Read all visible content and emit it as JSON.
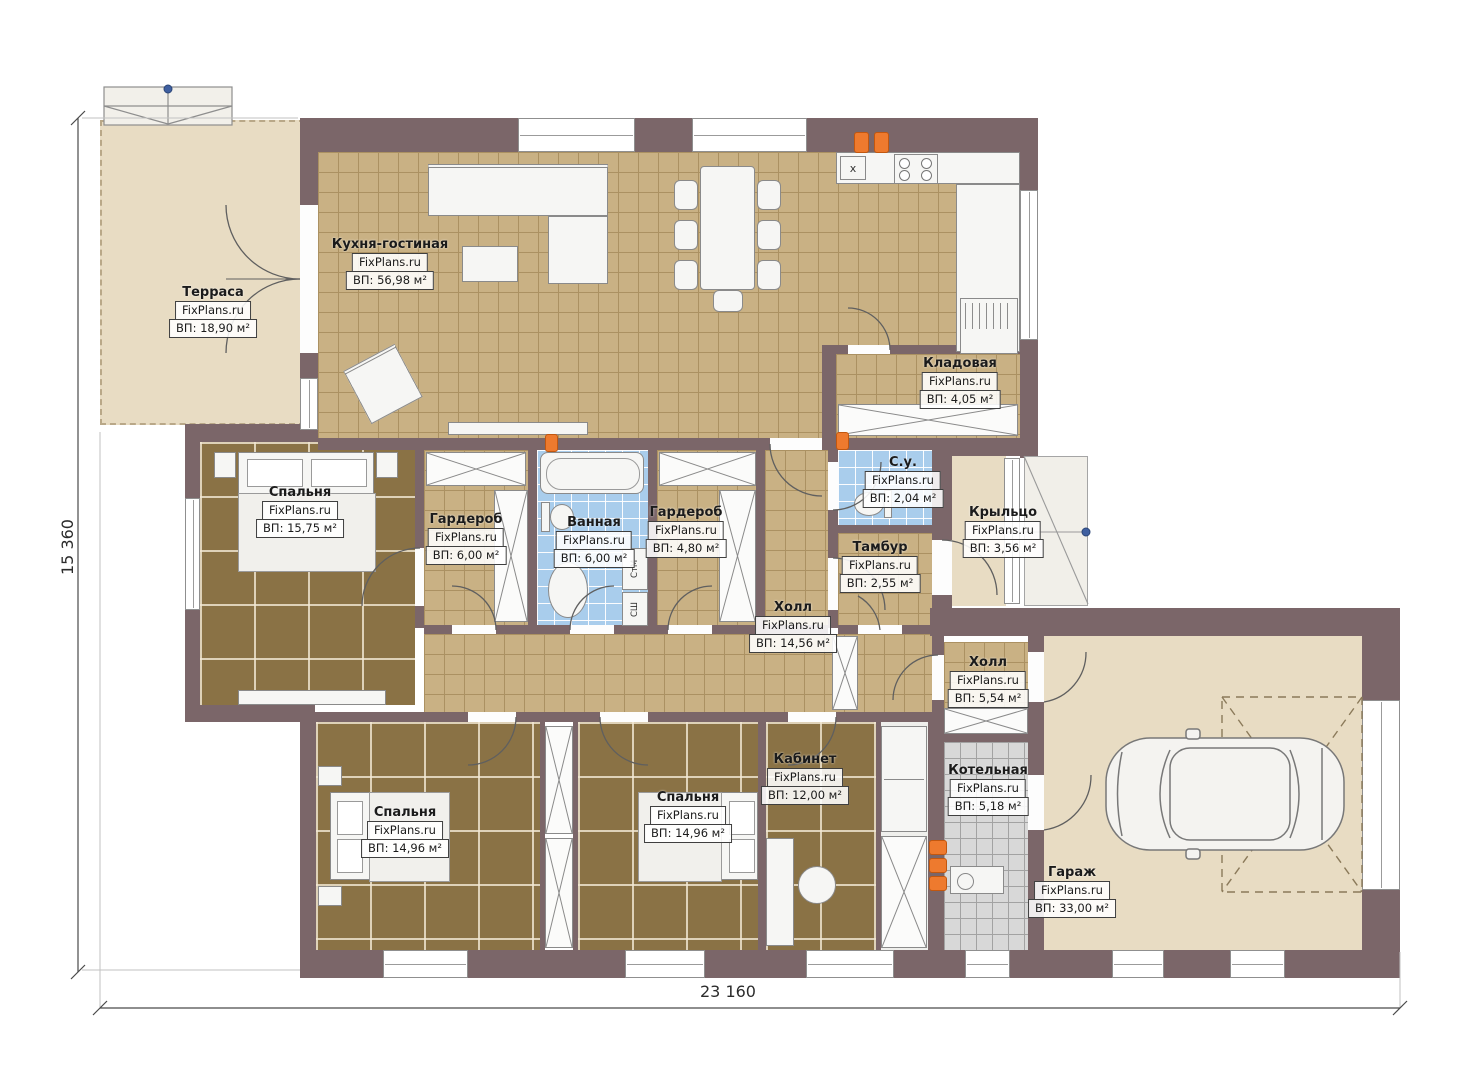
{
  "plan": {
    "dimension_bottom": "23 160",
    "dimension_left": "15 360"
  },
  "rooms": [
    {
      "name": "Терраса",
      "brand": "FixPlans.ru",
      "area": "ВП: 18,90 м²"
    },
    {
      "name": "Кухня-гостиная",
      "brand": "FixPlans.ru",
      "area": "ВП: 56,98 м²"
    },
    {
      "name": "Кладовая",
      "brand": "FixPlans.ru",
      "area": "ВП: 4,05 м²"
    },
    {
      "name": "Спальня",
      "brand": "FixPlans.ru",
      "area": "ВП: 15,75 м²"
    },
    {
      "name": "Гардероб",
      "brand": "FixPlans.ru",
      "area": "ВП: 6,00 м²"
    },
    {
      "name": "Ванная",
      "brand": "FixPlans.ru",
      "area": "ВП: 6,00 м²"
    },
    {
      "name": "Гардероб",
      "brand": "FixPlans.ru",
      "area": "ВП: 4,80 м²"
    },
    {
      "name": "С.у.",
      "brand": "FixPlans.ru",
      "area": "ВП: 2,04 м²"
    },
    {
      "name": "Тамбур",
      "brand": "FixPlans.ru",
      "area": "ВП: 2,55 м²"
    },
    {
      "name": "Крыльцо",
      "brand": "FixPlans.ru",
      "area": "ВП: 3,56 м²"
    },
    {
      "name": "Холл",
      "brand": "FixPlans.ru",
      "area": "ВП: 14,56 м²"
    },
    {
      "name": "Холл",
      "brand": "FixPlans.ru",
      "area": "ВП: 5,54 м²"
    },
    {
      "name": "Спальня",
      "brand": "FixPlans.ru",
      "area": "ВП: 14,96 м²"
    },
    {
      "name": "Спальня",
      "brand": "FixPlans.ru",
      "area": "ВП: 14,96 м²"
    },
    {
      "name": "Кабинет",
      "brand": "FixPlans.ru",
      "area": "ВП: 12,00 м²"
    },
    {
      "name": "Котельная",
      "brand": "FixPlans.ru",
      "area": "ВП: 5,18 м²"
    },
    {
      "name": "Гараж",
      "brand": "FixPlans.ru",
      "area": "ВП: 33,00 м²"
    }
  ],
  "appliances": {
    "washer": "СтМ",
    "dryer": "СШ",
    "sink_mark": "x"
  },
  "colors": {
    "wall": "#7b6669",
    "tile_tan": "#c9b184",
    "tile_brown": "#8a7245",
    "tile_blue": "#a9cdec",
    "tile_gray": "#d8d8d8",
    "floor_beige": "#e8dcc3",
    "radiator_orange": "#ee7a2e",
    "marker_blue": "#3f5fa0"
  }
}
